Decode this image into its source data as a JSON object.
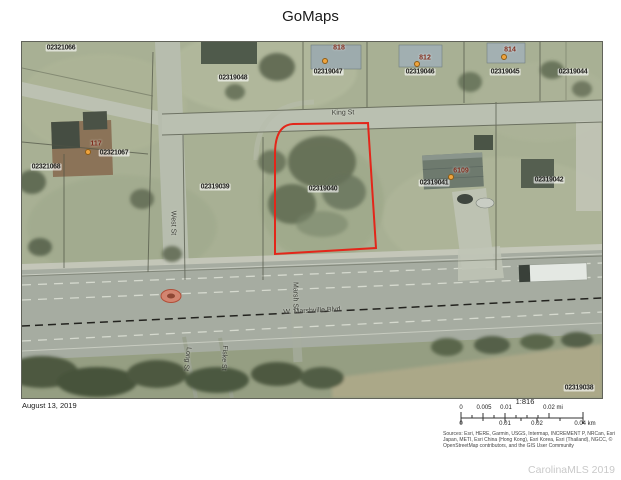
{
  "title": "GoMaps",
  "map": {
    "selected_parcel": "02319040",
    "selection_outline_color": "#e3261a",
    "house_number_color": "#7e2a1a",
    "address_dot_color": "#efa43d",
    "parcel_labels": [
      "02321066",
      "02319048",
      "02319047",
      "02319046",
      "02319045",
      "02319044",
      "02321068",
      "02321067",
      "02319039",
      "02319040",
      "02319041",
      "02319042",
      "02319038"
    ],
    "house_numbers": [
      "818",
      "812",
      "814",
      "117",
      "6109"
    ],
    "streets": {
      "king": "King St",
      "west": "West St",
      "marshville": "W. Marshville Blvd",
      "marsh": "Marsh St",
      "long": "Long St",
      "fiske": "Fiske St"
    }
  },
  "footer": {
    "date": "August 13, 2019",
    "scale_ratio": "1:816",
    "scalebar": {
      "mi_ticks": [
        "0",
        "0.005",
        "0.01",
        "0.02 mi"
      ],
      "km_ticks": [
        "0",
        "0.01",
        "0.02",
        "0.04 km"
      ]
    },
    "sources": "Sources: Esri, HERE, Garmin, USGS, Intermap, INCREMENT P, NRCan, Esri Japan, METI, Esri China (Hong Kong), Esri Korea, Esri (Thailand), NGCC, © OpenStreetMap contributors, and the GIS User Community",
    "watermark": "CarolinaMLS 2019"
  }
}
